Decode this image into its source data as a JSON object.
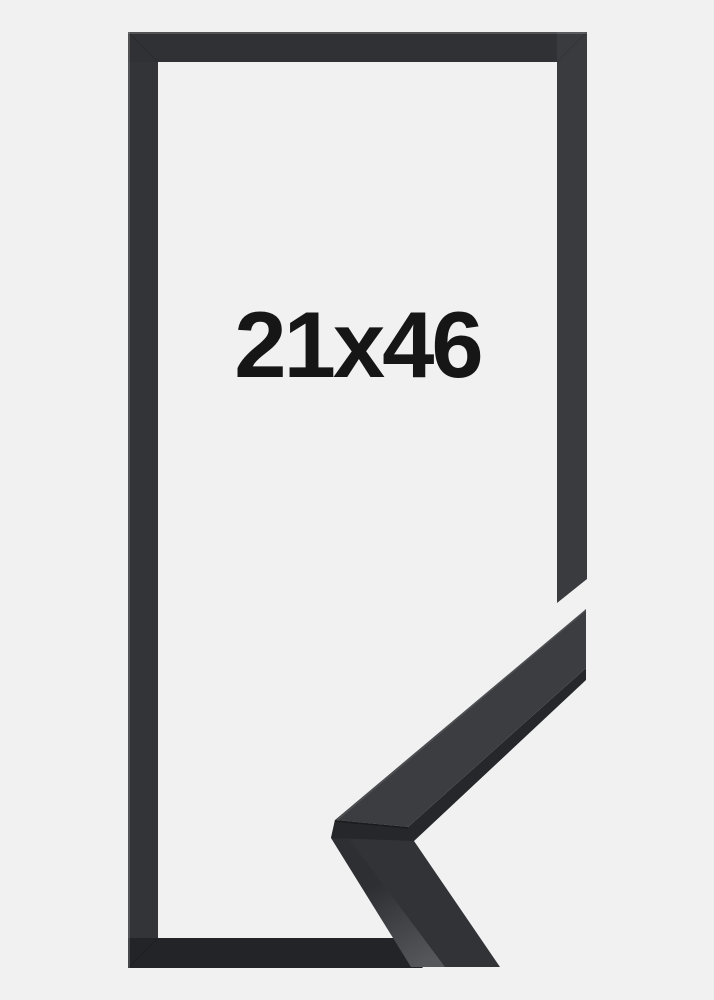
{
  "product": {
    "size_label": "21x46"
  },
  "colors": {
    "bg": "#f1f1f2",
    "label": "#161616",
    "frame-top": "#303134",
    "frame-left": "#333438",
    "frame-right": "#3a3b3e",
    "frame-bottom": "#232428",
    "sample-face-upper": "#3c3d40",
    "sample-side-upper": "#26272a",
    "sample-face-lower": "#323337",
    "sample-band-top": "#2e2f32",
    "sample-band-bottom": "#55575b",
    "edge-highlight": "rgba(255,255,255,0.22)",
    "miter-seam": "rgba(0,0,0,0.30)"
  }
}
